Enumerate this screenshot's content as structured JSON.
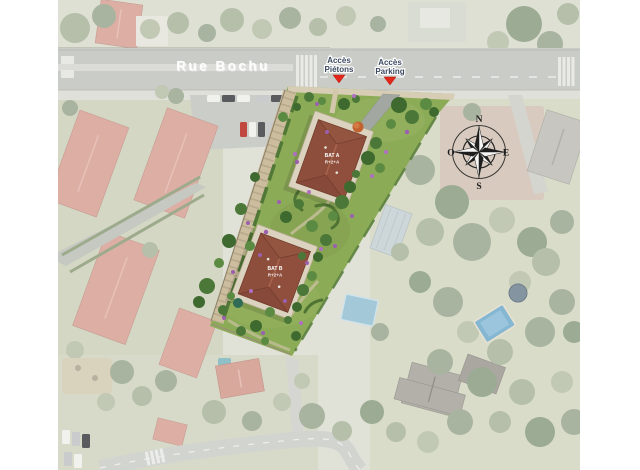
{
  "street": {
    "name": "Rue Bochu"
  },
  "access": {
    "pietons": {
      "line1": "Accès",
      "line2": "Piétons"
    },
    "parking": {
      "line1": "Accès",
      "line2": "Parking"
    }
  },
  "buildings": {
    "a": {
      "name": "BAT A",
      "floors": "R+2+A"
    },
    "b": {
      "name": "BAT B",
      "floors": "R+2+A"
    }
  },
  "compass": {
    "n": "N",
    "e": "E",
    "s": "S",
    "o": "O"
  },
  "colors": {
    "site_grass": "#8cab57",
    "roof_terracotta": "#8d4e3b",
    "path_beige": "#ccbd9e",
    "access_arrow_red": "#e3261a",
    "access_label_navy": "#3c4961",
    "street_label_white": "#fdfdfb",
    "pool_blue": "#64a8cf",
    "compass_black": "#1f1f1f"
  }
}
